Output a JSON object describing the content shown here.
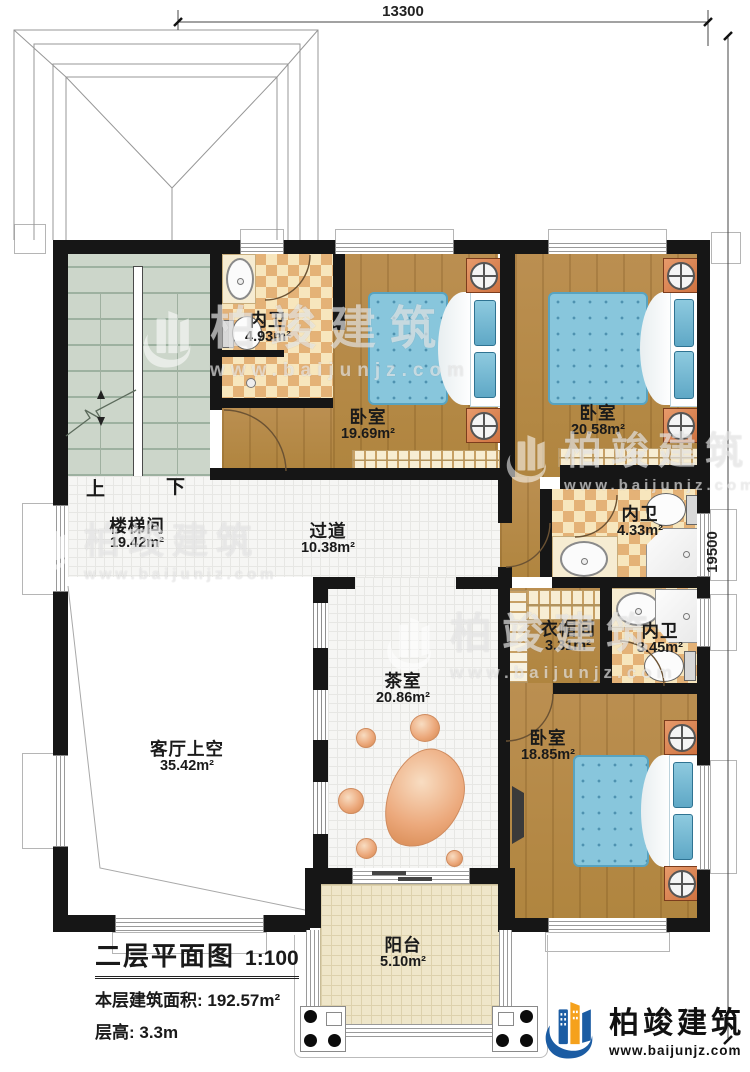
{
  "dimensions": {
    "top": "13300",
    "right": "19500"
  },
  "rooms": [
    {
      "name": "内卫",
      "area": "4.93m²"
    },
    {
      "name": "卧室",
      "area": "19.69m²"
    },
    {
      "name": "卧室",
      "area": "20.58m²"
    },
    {
      "name": "内卫",
      "area": "4.33m²"
    },
    {
      "name": "楼梯间",
      "area": "19.42m²"
    },
    {
      "name": "过道",
      "area": "10.38m²"
    },
    {
      "name": "衣帽间",
      "area": "3.31m²"
    },
    {
      "name": "内卫",
      "area": "3.45m²"
    },
    {
      "name": "茶室",
      "area": "20.86m²"
    },
    {
      "name": "客厅上空",
      "area": "35.42m²"
    },
    {
      "name": "卧室",
      "area": "18.85m²"
    },
    {
      "name": "阳台",
      "area": "5.10m²"
    }
  ],
  "stairs": {
    "up": "上",
    "down": "下"
  },
  "title_block": {
    "title": "二层平面图",
    "scale": "1:100",
    "floor_area": "本层建筑面积: 192.57m²",
    "floor_height": "层高: 3.3m"
  },
  "brand": {
    "name": "柏竣建筑",
    "url": "www.baijunjz.com"
  },
  "colors": {
    "wall": "#161616",
    "wood": "#b78c4e",
    "tile_tan": "#e4b277",
    "tile_cream": "#f7e6bd",
    "stair": "#ccd6ca",
    "bed_blue": "#88c6dc",
    "brand_blue": "#1b5ca3",
    "brand_orange": "#f5a11c"
  }
}
